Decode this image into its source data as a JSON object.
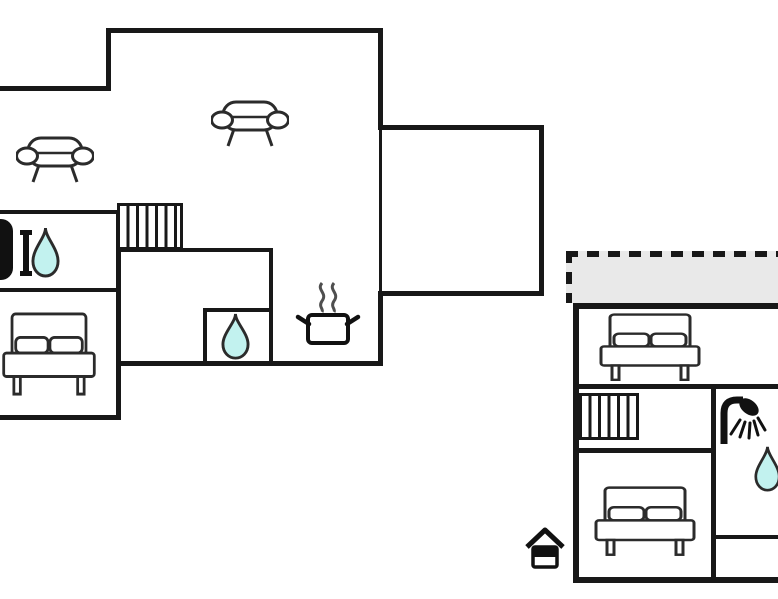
{
  "palette": {
    "background": "#ffffff",
    "wall": "#181818",
    "furniture_outline": "#2b2b2b",
    "icon_black": "#111111",
    "water_drop": "#c2f2ef",
    "terrace": "#e9e9e9",
    "steam": "#4f4f4f"
  },
  "ground_floor": {
    "name": "ground-floor-plan",
    "rooms": [
      {
        "name": "living-area",
        "icons": [
          "sofa-icon",
          "sofa-icon"
        ]
      },
      {
        "name": "bathroom",
        "icons": [
          "bathtub-icon",
          "water-drop-icon"
        ]
      },
      {
        "name": "bedroom",
        "icons": [
          "double-bed-icon"
        ]
      },
      {
        "name": "hall",
        "icons": [
          "stairs-icon"
        ]
      },
      {
        "name": "wc",
        "icons": [
          "water-drop-icon"
        ]
      },
      {
        "name": "kitchen",
        "icons": [
          "cooking-pot-icon"
        ]
      },
      {
        "name": "side-room",
        "icons": []
      }
    ]
  },
  "upper_floor": {
    "name": "upper-floor-plan",
    "rooms": [
      {
        "name": "terrace",
        "border_style": "dashed"
      },
      {
        "name": "bedroom-1",
        "icons": [
          "double-bed-icon"
        ]
      },
      {
        "name": "landing",
        "icons": [
          "stairs-icon"
        ]
      },
      {
        "name": "shower-room",
        "icons": [
          "shower-icon",
          "water-drop-icon"
        ]
      },
      {
        "name": "bedroom-2",
        "icons": [
          "double-bed-icon"
        ]
      },
      {
        "name": "entrance",
        "icons": [
          "house-icon"
        ]
      }
    ]
  }
}
